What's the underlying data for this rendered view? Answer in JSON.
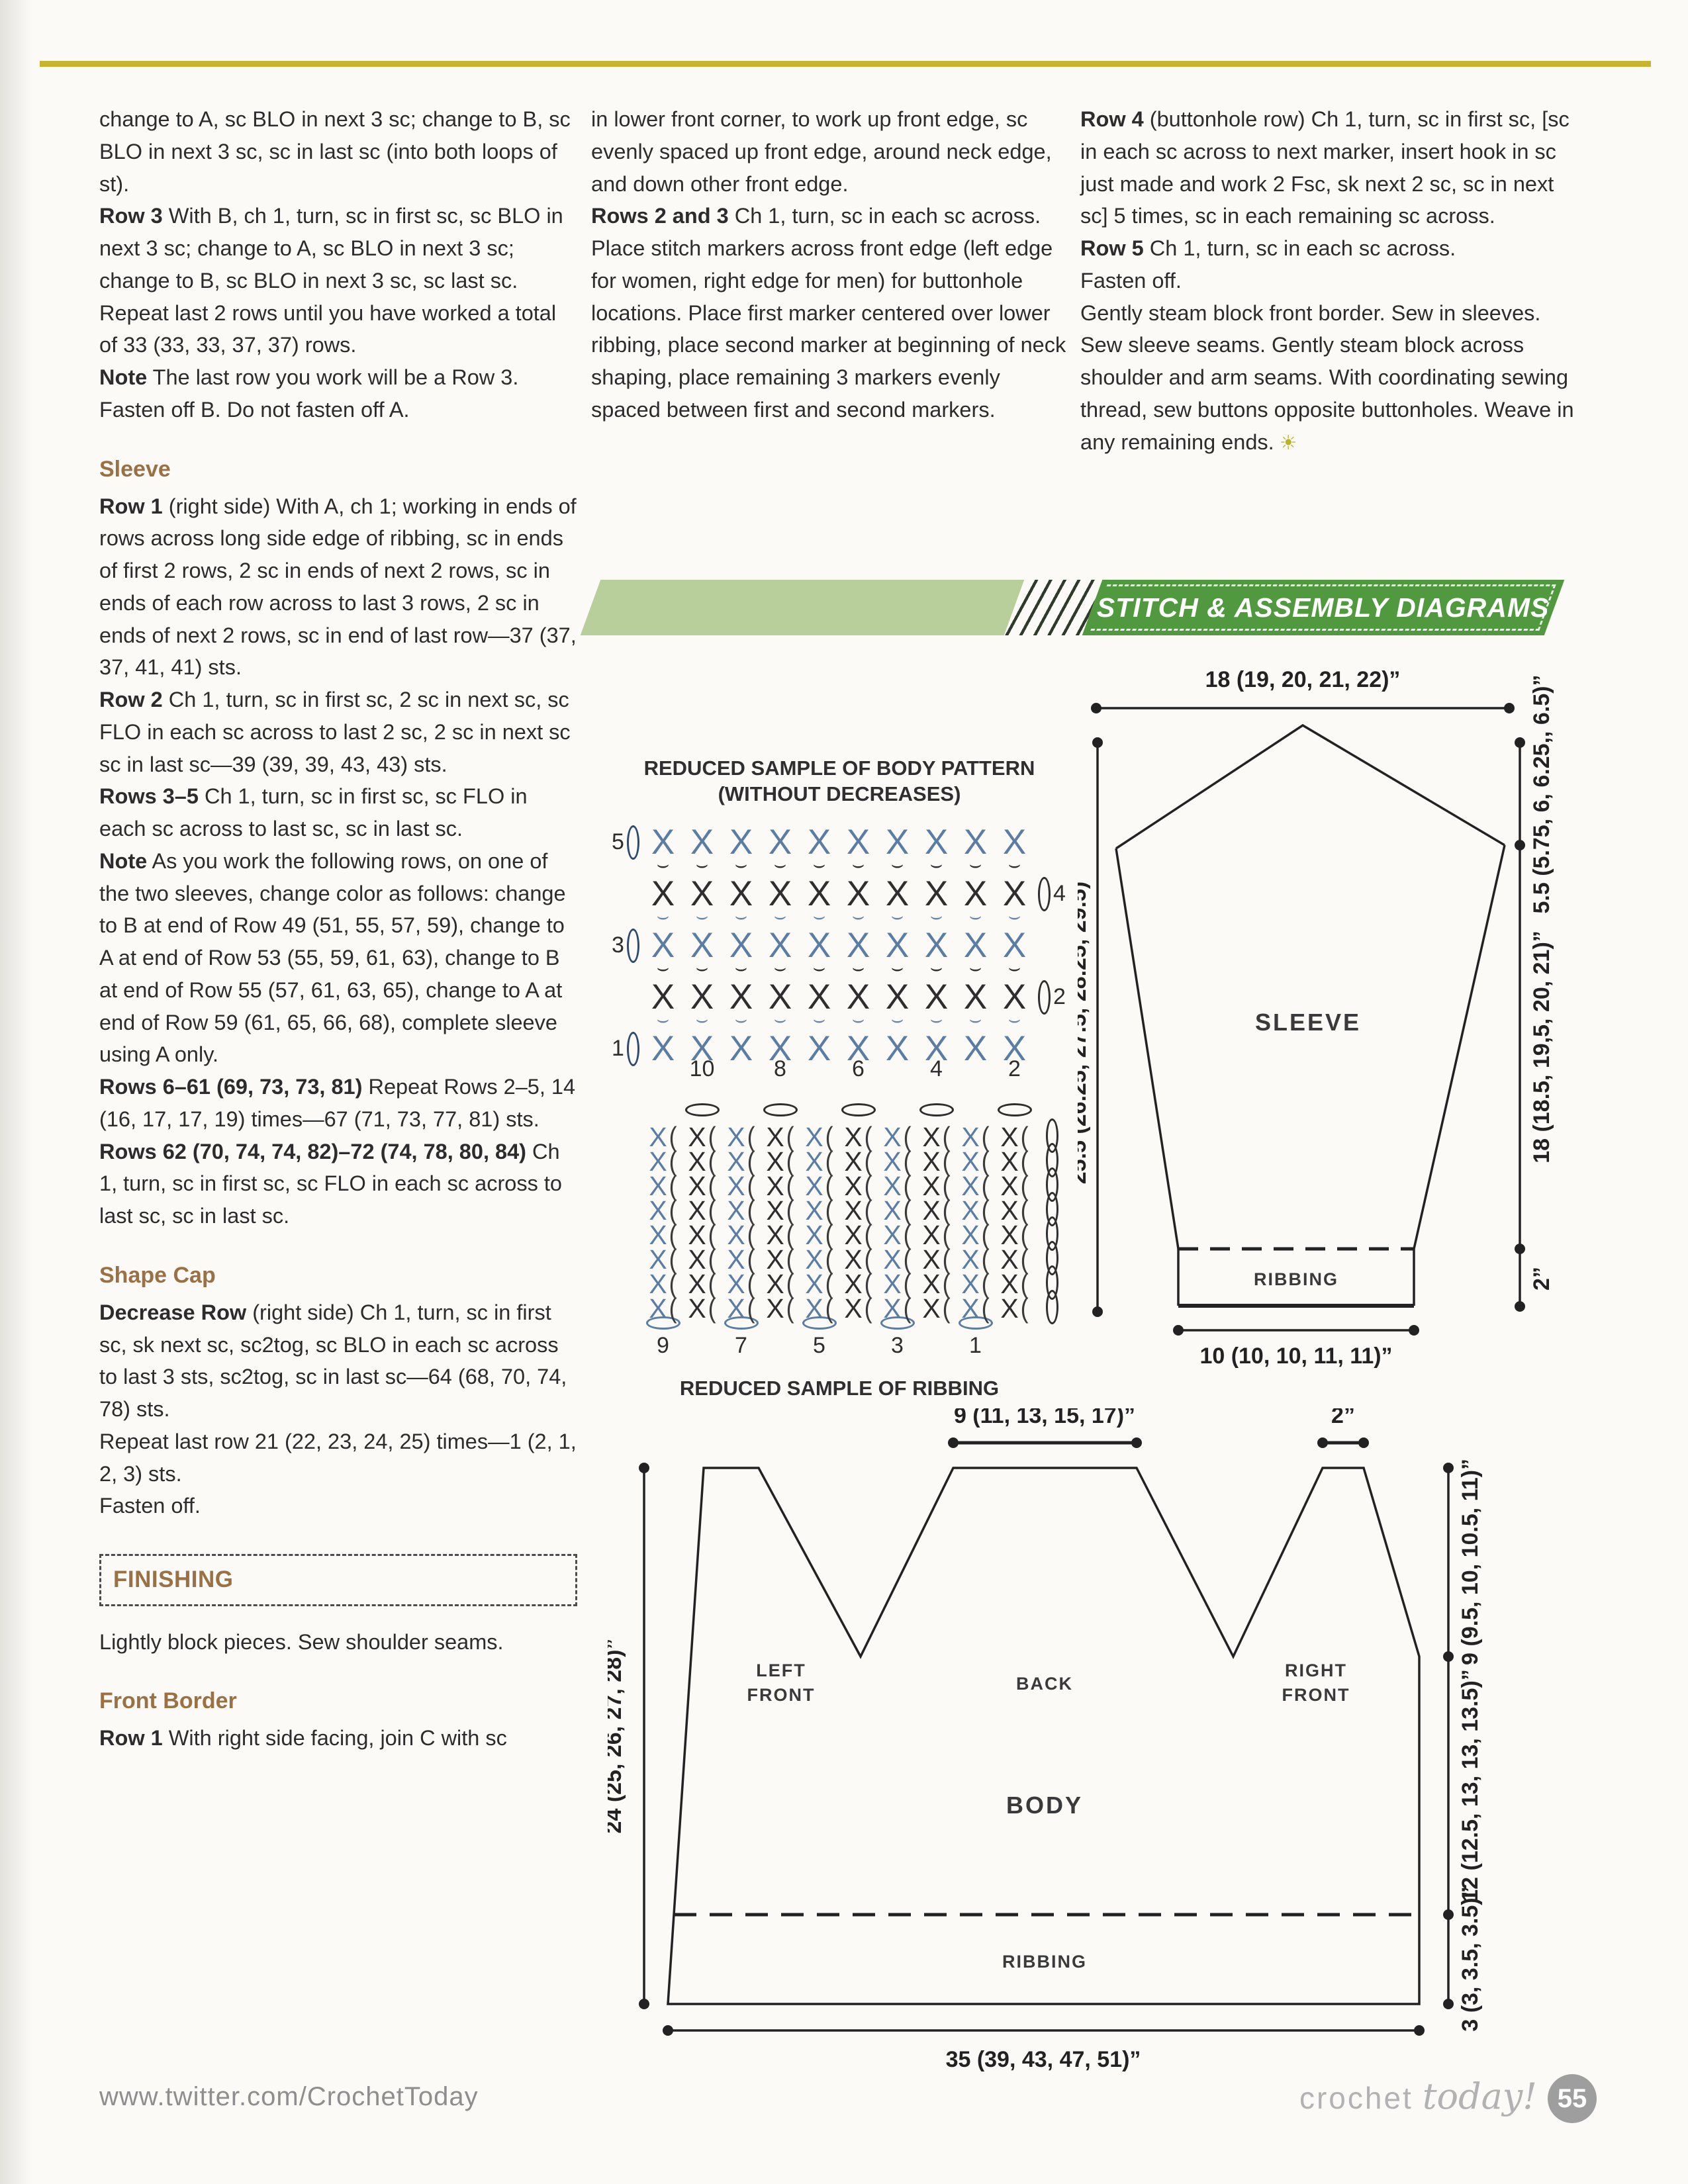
{
  "banner": {
    "title": "STITCH & ASSEMBLY DIAGRAMS"
  },
  "columns": {
    "col1": [
      {
        "text": "change to A, sc BLO in next 3 sc; change to B, sc BLO in next 3 sc, sc in last sc (into both loops of st)."
      },
      {
        "lead": "Row 3",
        "text": " With B, ch 1, turn, sc in first sc, sc BLO in next 3 sc; change to A, sc BLO in next 3 sc; change to B, sc BLO in next 3 sc, sc last sc."
      },
      {
        "text": "Repeat last 2 rows until you have worked a total of 33 (33, 33, 37, 37) rows."
      },
      {
        "lead": "Note",
        "text": " The last row you work will be a Row 3. Fasten off B. Do not fasten off A."
      },
      {
        "h": "Sleeve"
      },
      {
        "lead": "Row 1",
        "text": " (right side) With A, ch 1; working in ends of rows across long side edge of ribbing, sc in ends of first 2 rows, 2 sc in ends of next 2 rows, sc in ends of each row across to last 3 rows, 2 sc in ends of next 2 rows, sc in end of last row—37 (37, 37, 41, 41) sts."
      },
      {
        "lead": "Row 2",
        "text": " Ch 1, turn, sc in first sc, 2 sc in next sc, sc FLO in each sc across to last 2 sc, 2 sc in next sc sc in last sc—39 (39, 39, 43, 43) sts."
      },
      {
        "lead": "Rows 3–5",
        "text": " Ch 1, turn, sc in first sc, sc FLO in each sc across to last sc, sc in last sc."
      },
      {
        "lead": "Note",
        "text": " As you work the following rows, on one of the two sleeves, change color as follows: change to B at end of Row 49 (51, 55, 57, 59), change to A at end of Row 53 (55, 59, 61, 63), change to B at end of Row 55 (57, 61, 63, 65), change to A at end of Row 59 (61, 65, 66, 68), complete sleeve using A only."
      },
      {
        "lead": "Rows 6–61 (69, 73, 73, 81)",
        "text": " Repeat Rows 2–5, 14 (16, 17, 17, 19) times—67 (71, 73, 77, 81) sts."
      },
      {
        "lead": "Rows 62 (70, 74, 74, 82)–72 (74, 78, 80, 84)",
        "text": " Ch 1, turn, sc in first sc, sc FLO in each sc across to last sc, sc in last sc."
      },
      {
        "h": "Shape Cap"
      },
      {
        "lead": "Decrease Row",
        "text": " (right side) Ch 1, turn, sc in first sc, sk next sc, sc2tog, sc BLO in each sc across to last 3 sts, sc2tog, sc in last sc—64 (68, 70, 74, 78) sts."
      },
      {
        "text": "Repeat last row 21 (22, 23, 24, 25) times—1 (2, 1, 2, 3) sts."
      },
      {
        "text": "Fasten off."
      },
      {
        "box": "FINISHING"
      },
      {
        "text": "Lightly block pieces. Sew shoulder seams."
      },
      {
        "h": "Front Border"
      },
      {
        "lead": "Row 1",
        "text": " With right side facing, join C with sc"
      }
    ],
    "col2": [
      {
        "text": "in lower front corner, to work up front edge, sc evenly spaced up front edge, around neck edge, and down other front edge."
      },
      {
        "lead": "Rows 2 and 3",
        "text": " Ch 1, turn, sc in each sc across."
      },
      {
        "text": "Place stitch markers across front edge (left edge for women, right edge for men) for buttonhole locations. Place first marker centered over lower ribbing, place second marker at beginning of neck shaping, place remaining 3 markers evenly spaced between first and second markers."
      }
    ],
    "col3": [
      {
        "lead": "Row 4",
        "text": " (buttonhole row) Ch 1, turn, sc in first sc, [sc in each sc across to next marker, insert hook in sc just made and work 2 Fsc, sk next 2 sc, sc in next sc] 5 times, sc in each remaining sc across."
      },
      {
        "lead": "Row 5",
        "text": " Ch 1, turn, sc in each sc across."
      },
      {
        "text": "Fasten off."
      },
      {
        "text": "Gently steam block front border. Sew in sleeves. Sew sleeve seams. Gently steam block across shoulder and arm seams. With coordinating sewing thread, sew buttons opposite buttonholes. Weave in any remaining ends.",
        "icon": "☀"
      }
    ]
  },
  "diagrams": {
    "body_pattern": {
      "title_line1": "REDUCED SAMPLE OF BODY PATTERN",
      "title_line2": "(WITHOUT DECREASES)",
      "stitch_rows": 5,
      "stitches_per_row": 10,
      "row_numbers_left": [
        "5",
        "3",
        "1"
      ],
      "row_numbers_right": [
        "4",
        "2"
      ],
      "bottom_numbers": [
        "10",
        "8",
        "6",
        "4",
        "2"
      ]
    },
    "ribbing_pattern": {
      "rows": 8,
      "columns": 10,
      "bottom_numbers": [
        "9",
        "7",
        "5",
        "3",
        "1"
      ],
      "label": "REDUCED SAMPLE OF RIBBING"
    },
    "sleeve": {
      "top_width": "18 (19, 20, 21, 22)”",
      "side_height": "25.5 (26.25, 27.5, 28.25, 29.5)”",
      "cap_height": "5.5 (5.75, 6, 6.25,, 6.5)”",
      "arm_height": "18 (18.5, 19,5, 20, 21)”",
      "ribbing_height": "2”",
      "cuff_width": "10 (10, 10, 11, 11)”",
      "label": "SLEEVE",
      "ribbing_label": "RIBBING"
    },
    "body": {
      "back_neck_width": "9 (11, 13, 15, 17)”",
      "shoulder_width": "2”",
      "side_height": "24 (25, 26, 27, 28)”",
      "armhole_depth": "9 (9.5, 10, 10.5, 11)”",
      "lower_height": "12 (12.5, 13, 13, 13.5)”",
      "ribbing_height": "3 (3, 3.5, 3.5)”",
      "bottom_width": "35 (39, 43, 47, 51)”",
      "left_front_line1": "LEFT",
      "left_front_line2": "FRONT",
      "back_label": "BACK",
      "right_front_line1": "RIGHT",
      "right_front_line2": "FRONT",
      "body_label": "BODY",
      "ribbing_label": "RIBBING"
    }
  },
  "footer": {
    "url": "www.twitter.com/CrochetToday",
    "logo_word1": "crochet",
    "logo_word2": "today!",
    "page_number": "55"
  },
  "colors": {
    "gold_rule": "#c9b430",
    "banner_light_green": "#b8cf9c",
    "banner_dark_green": "#51993e",
    "heading_brown": "#9a7145",
    "diagram_blue": "#5b7ca3",
    "text_dark": "#2c2c2c"
  }
}
